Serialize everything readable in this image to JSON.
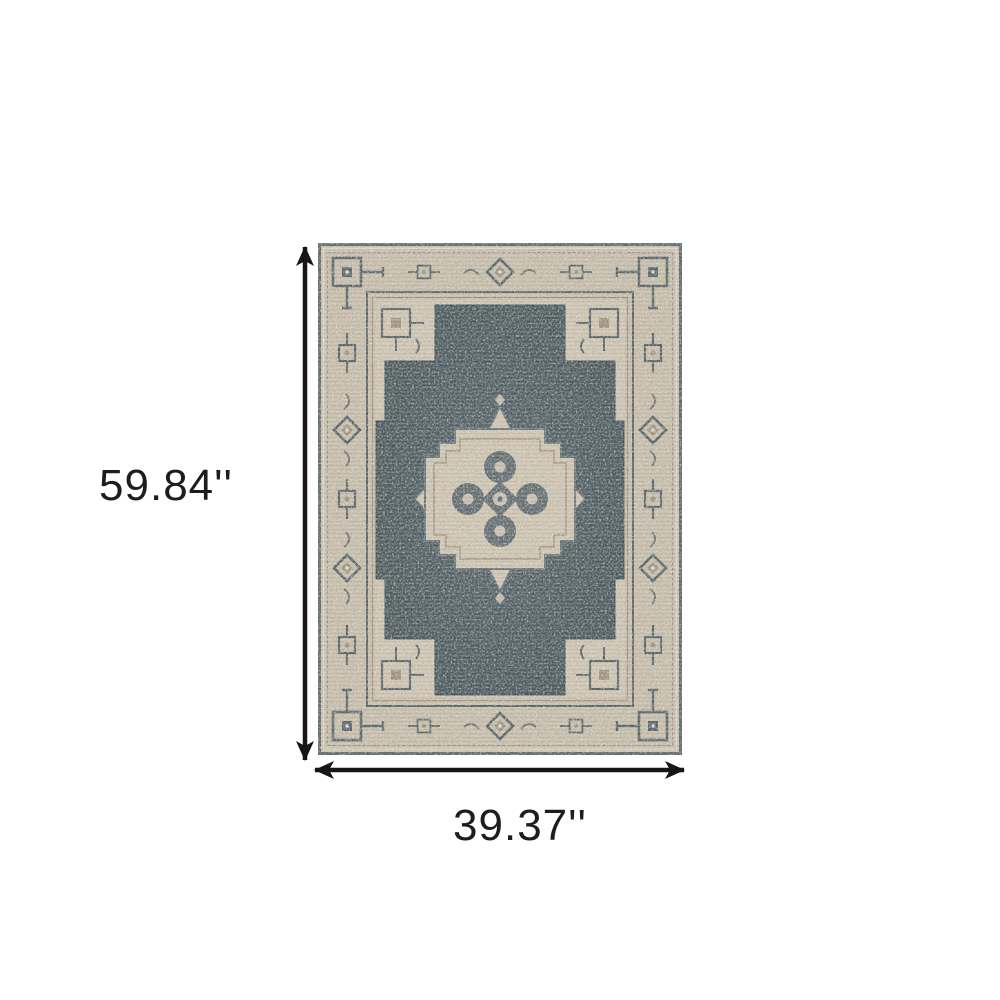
{
  "figure": {
    "kind": "rug-product-dimension-diagram",
    "height": {
      "label": "59.84''",
      "value_inches": 59.84,
      "orientation": "vertical"
    },
    "width": {
      "label": "39.37''",
      "value_inches": 39.37,
      "orientation": "horizontal"
    }
  },
  "rug": {
    "motifs": [
      "border-corner-square",
      "border-diamond-medallion",
      "stepped-field-medallion",
      "center-quatrefoil-medallion"
    ]
  },
  "colors": {
    "background": "#ffffff",
    "dimension_line": "#161616",
    "label_text": "#1d1d1d",
    "field_dark": "#4e5d63",
    "field_dark_light": "#5a686d",
    "border_beige": "#c7bdab",
    "inner_beige": "#cec4b2",
    "motif_outline": "#57646a",
    "motif_taupe": "#a0937e",
    "cream": "#e2dccd",
    "edge_dark": "#5e6a6c"
  }
}
